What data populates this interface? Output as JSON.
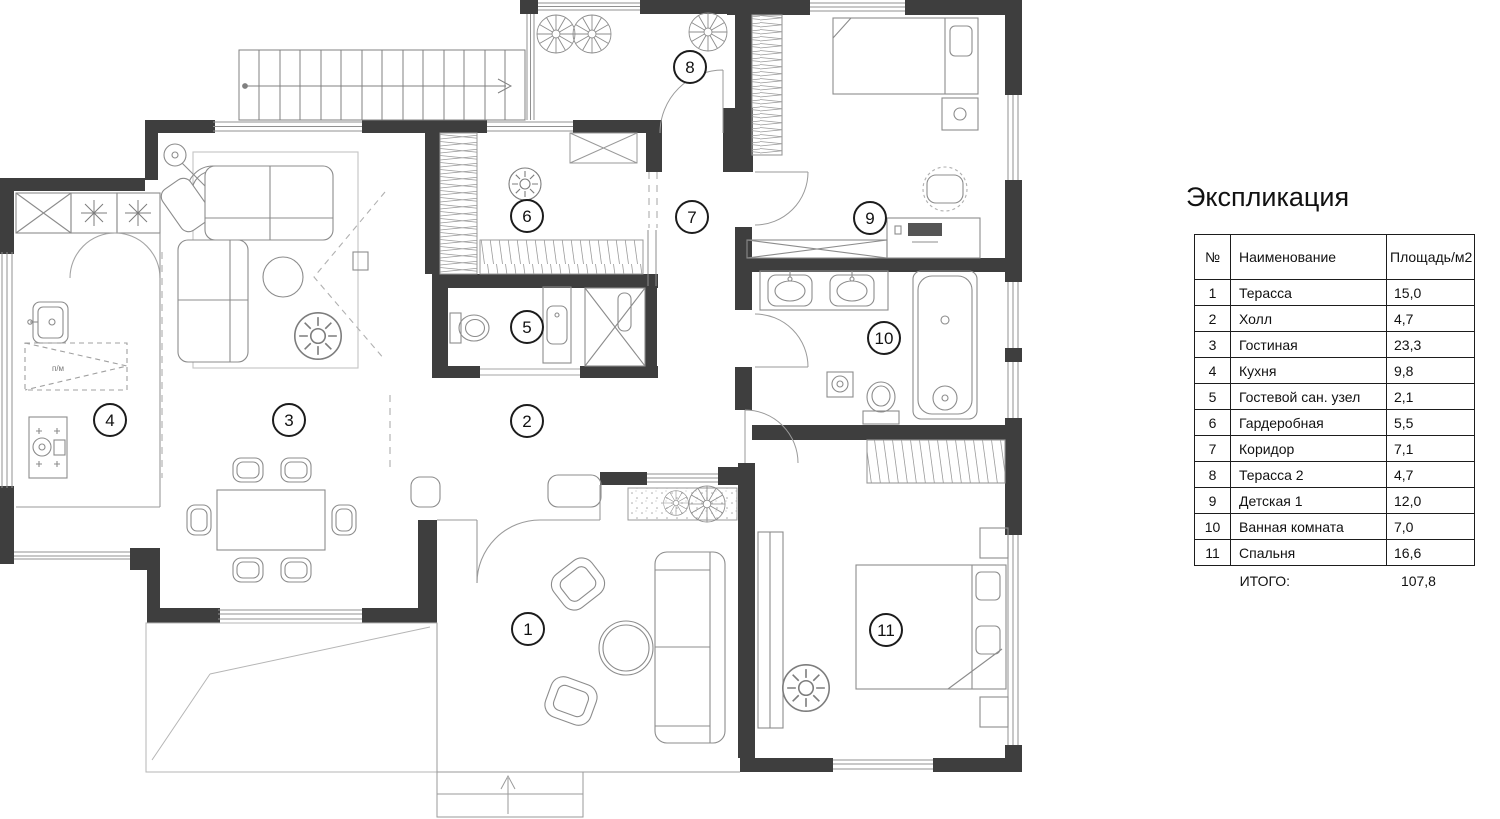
{
  "legend": {
    "title": "Экспликация",
    "columns": {
      "num": "№",
      "name": "Наименование",
      "area": "Площадь/м2"
    },
    "rows": [
      {
        "num": "1",
        "name": "Терасса",
        "area": "15,0"
      },
      {
        "num": "2",
        "name": "Холл",
        "area": "4,7"
      },
      {
        "num": "3",
        "name": "Гостиная",
        "area": "23,3"
      },
      {
        "num": "4",
        "name": "Кухня",
        "area": "9,8"
      },
      {
        "num": "5",
        "name": "Гостевой сан. узел",
        "area": "2,1"
      },
      {
        "num": "6",
        "name": "Гардеробная",
        "area": "5,5"
      },
      {
        "num": "7",
        "name": "Коридор",
        "area": "7,1"
      },
      {
        "num": "8",
        "name": "Терасса 2",
        "area": "4,7"
      },
      {
        "num": "9",
        "name": "Детская 1",
        "area": "12,0"
      },
      {
        "num": "10",
        "name": "Ванная комната",
        "area": "7,0"
      },
      {
        "num": "11",
        "name": "Спальня",
        "area": "16,6"
      }
    ],
    "total_label": "ИТОГО:",
    "total_value": "107,8"
  },
  "plan": {
    "room_markers": [
      {
        "n": "1"
      },
      {
        "n": "2"
      },
      {
        "n": "3"
      },
      {
        "n": "4"
      },
      {
        "n": "5"
      },
      {
        "n": "6"
      },
      {
        "n": "7"
      },
      {
        "n": "8"
      },
      {
        "n": "9"
      },
      {
        "n": "10"
      },
      {
        "n": "11"
      }
    ],
    "kitchen_dishwasher_label": "п/м",
    "colors": {
      "wall": "#3e3e3e",
      "furniture_line": "#8c8c8c",
      "window_line": "#909090"
    }
  }
}
